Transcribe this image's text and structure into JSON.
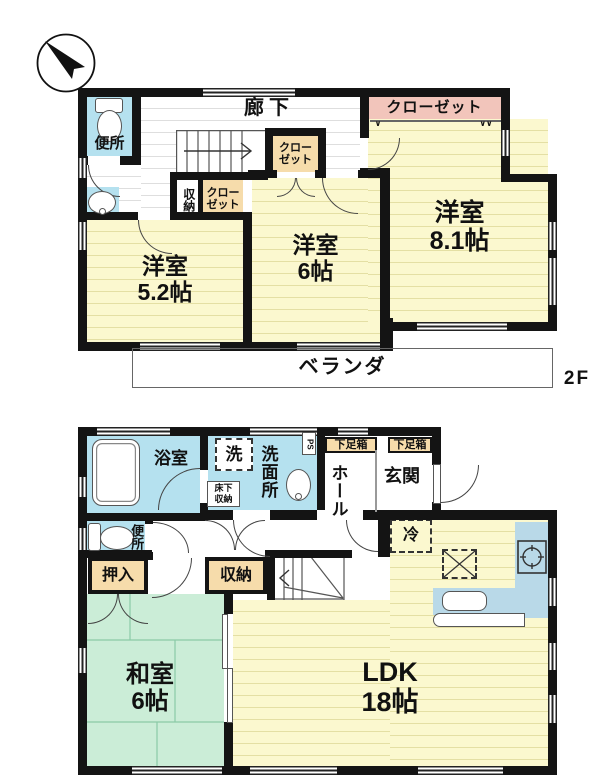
{
  "compass": {
    "north_label": "N"
  },
  "f2": {
    "tag": "2F",
    "benjo": "便所",
    "roka": "廊下",
    "closet_main": "クローゼット",
    "closet_a": "クローゼット",
    "shuno": "収納",
    "closet_b": "クローゼット",
    "y52": {
      "n": "洋室",
      "s": "5.2帖"
    },
    "y6": {
      "n": "洋室",
      "s": "6帖"
    },
    "y81": {
      "n": "洋室",
      "s": "8.1帖"
    },
    "veranda": "ベランダ",
    "hanger_left": "∨",
    "hanger_right": "∨∨"
  },
  "f1": {
    "yokushitsu": "浴室",
    "sen": "洗",
    "senmenjo": "洗面所",
    "yukashita": "床下収納",
    "ps": "PS",
    "geta1": "下足箱",
    "geta2": "下足箱",
    "hall": "ホール",
    "genkan": "玄関",
    "benjo": "便所",
    "oshiire": "押入",
    "shuno": "収納",
    "rei": "冷",
    "washitsu": {
      "n": "和室",
      "s": "6帖"
    },
    "ldk": {
      "n": "LDK",
      "s": "18帖"
    }
  },
  "colors": {
    "room_yellow": "#fbf8cf",
    "tatami_green": "#cbedd7",
    "water_blue": "#b5e1ef",
    "closet_tan": "#f6dcab",
    "closet_pink": "#f2c5bb",
    "wall_black": "#141414"
  }
}
